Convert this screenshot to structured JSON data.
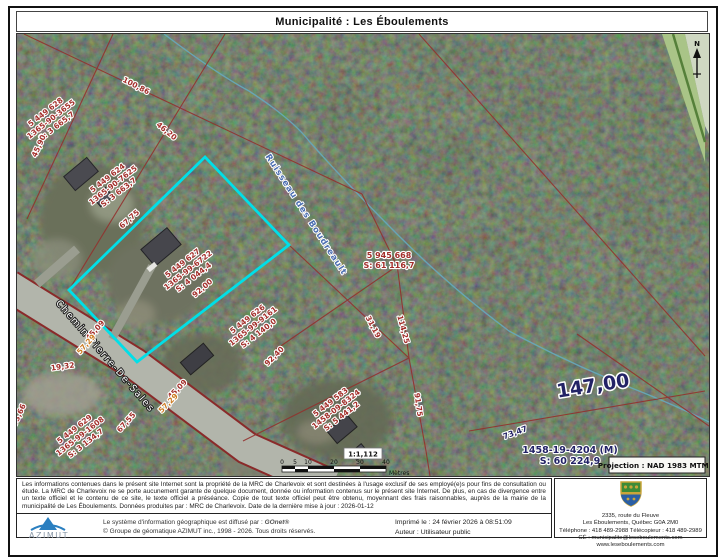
{
  "header": {
    "title": "Municipalité : Les Éboulements"
  },
  "map": {
    "road_label": "Chemin Pierre-De-Sales",
    "stream_label": "Ruisseau des Boudreault",
    "north_label": "N",
    "lots": [
      {
        "lot": "5 449 628",
        "mat": "1365-90-3655",
        "area": "S: 3 665,7"
      },
      {
        "lot": "5 449 624",
        "mat": "1365-90-7625",
        "area": "S: 3 663,7"
      },
      {
        "lot": "5 449 627",
        "mat": "1365-99-6722",
        "area": "S: 4 044,4"
      },
      {
        "lot": "5 449 626",
        "mat": "1365-99-9161",
        "area": "S: 4 140,0"
      },
      {
        "lot": "5 449 629",
        "mat": "1365-99-1608",
        "area": "S: 3 134,7"
      },
      {
        "lot": "5 449 583",
        "mat": "1458-09-8324",
        "area": "S: 5 441,2"
      }
    ],
    "parcel1": {
      "lot": "5 945 668",
      "area": "S: 61 116,7"
    },
    "parcel2": {
      "mat": "1458-19-4204 (M)",
      "area": "S: 60 224,9"
    },
    "big": {
      "main": "147,00",
      "small": "73,47"
    },
    "measurements": [
      "100,86",
      "46,20",
      "45,90",
      "67,75",
      "92,00",
      "45,09",
      "57,29",
      "19,32",
      "67,55",
      "45,09",
      "57,29",
      "92,40",
      "31,19",
      "114,25",
      "91,75",
      "93,66"
    ],
    "colors": {
      "selection": "#00dfe8",
      "cadastral_line": "#93312e",
      "stream": "#66a8b8"
    }
  },
  "scalebar": {
    "ratio": "1:1,112",
    "ticks": [
      "0",
      "5",
      "10",
      "20",
      "30",
      "40"
    ],
    "unit": "Mètres"
  },
  "projection": {
    "label": "Projection : NAD 1983 MTM 7"
  },
  "footer": {
    "disclaimer": "Les informations contenues dans le présent site Internet sont la propriété de la MRC de Charlevoix et sont destinées à l'usage exclusif de ses employé(e)s pour fins de consultation ou étude. La MRC de Charlevoix ne se porte aucunement garante de quelque document, donnée ou information contenus sur le présent site Internet. De plus, en cas de divergence entre un texte officiel et le contenu de ce site, le texte officiel a préséance. Copie de tout texte officiel peut être obtenu, moyennant des frais raisonnables, auprès de la mairie de la municipalité de Les Éboulements. Données produites par : MRC de Charlevoix. Date de la dernière mise à jour : 2026-01-12",
    "azimut": "AZIMUT",
    "diffuse_prefix": "Le système d'information géographique est diffusé par : ",
    "gonet": "GOnet®",
    "copyright": "© Groupe de géomatique AZIMUT inc., 1998 - 2026. Tous droits réservés.",
    "printed": "Imprimé le : 24 février 2026 à 08:51:09",
    "author": "Auteur : Utilisateur public",
    "address": [
      "2335, route du Fleuve",
      "Les Éboulements, Québec G0A 2M0",
      "Téléphone : 418 489-2988 Télécopieur : 418 489-2989",
      "CÉ : municipalite@leseboulements.com",
      "www.leseboulements.com"
    ]
  }
}
